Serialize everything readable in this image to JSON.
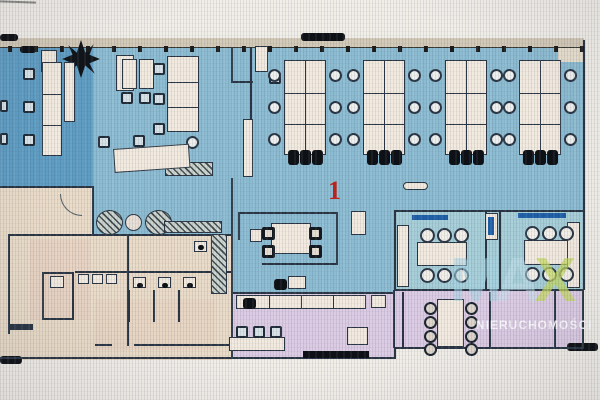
{
  "labels": {
    "unit": "1"
  },
  "watermark": {
    "logo_letters": [
      "M",
      "A",
      "X"
    ],
    "text": "NIERUCHOMOŚCI"
  },
  "colors": {
    "wall": "#2a3644",
    "floor_open": "#8cbcd2",
    "floor_lounge": "#5f9dc3",
    "floor_meeting": "#a6ced8",
    "floor_service": "#e9dbc7",
    "floor_rooms": "#dbcbe3",
    "desk": "#f2eadf",
    "bar": "#2060a8",
    "black": "#0d1014",
    "margin": "#f1eee8",
    "topwall": "#d3c9b7",
    "unit_label": "#bf231b",
    "logo_blue": "#a5d4e4",
    "logo_green": "#c5d95e",
    "wm_text": "#fcfcff"
  },
  "plan": {
    "window_ticks": {
      "count": 23,
      "start": 8,
      "step": 26,
      "y": 46
    },
    "desk_clusters": [
      {
        "x": 284,
        "y": 60
      },
      {
        "x": 363,
        "y": 60
      },
      {
        "x": 445,
        "y": 60
      },
      {
        "x": 519,
        "y": 60
      }
    ],
    "cluster_spec": {
      "w": 42,
      "h": 95,
      "cols": 2,
      "rows": 3,
      "side_chair_ys": [
        9,
        41,
        73
      ],
      "end_seats": 3
    },
    "meeting_rooms": [
      {
        "bar": {
          "x": 412,
          "y": 215,
          "w": 36
        },
        "table": {
          "x": 417,
          "y": 242,
          "w": 50,
          "h": 24
        },
        "chair_xs": [
          420,
          437,
          454
        ],
        "chairs_top_y": 228,
        "chairs_bottom_y": 268
      },
      {
        "bar": {
          "x": 518,
          "y": 213,
          "w": 48
        },
        "table": {
          "x": 524,
          "y": 240,
          "w": 44,
          "h": 25
        },
        "chair_xs": [
          525,
          542,
          559
        ],
        "chairs_top_y": 226,
        "chairs_bottom_y": 267
      }
    ],
    "conference_room": {
      "table": {
        "x": 437,
        "y": 299,
        "w": 27,
        "h": 48
      },
      "chair_ys": [
        302,
        316,
        330,
        343
      ],
      "left_x": 424,
      "right_x": 465
    }
  }
}
